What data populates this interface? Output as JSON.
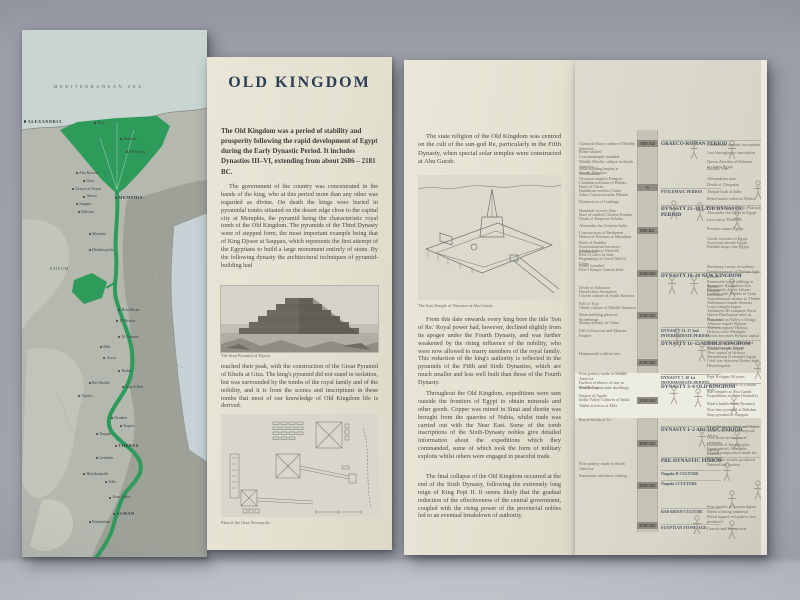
{
  "colors": {
    "background": "#9fa1ab",
    "paper_cream": "#e4e1d1",
    "map_land": "#b6bab1",
    "map_sea": "#c9d5d1",
    "nile_green": "#2f9b5b",
    "timeline_paper": "#d8d6c9",
    "timeline_highlight": "#edece1",
    "title_ink": "#2c3e54",
    "body_ink": "#4b493f"
  },
  "panel_old_kingdom": {
    "title": "OLD KINGDOM",
    "intro": "The Old Kingdom was a period of stability and prosperity following the rapid development of Egypt during the Early Dynastic Period. It includes Dynasties III–VI, extending from about 2686 – 2181 BC.",
    "para1": "The government of the country was concentrated in the hands of the king, who at this period more than any other was regarded as divine. On death the kings were buried in pyramidal tombs situated on the desert edge close to the capital city at Memphis, the pyramid being the characteristic royal tomb of the Old Kingdom. The pyramids of the Third Dynasty were of stepped form, the most important example being that of King Djoser at Saqqara, which represents the first attempt of the Egyptians to build a large monument entirely of stone. By the following dynasty the architectural techniques of pyramid-building had",
    "photo_caption": "The Step Pyramid of Djoser",
    "para2": "reached their peak, with the construction of the Great Pyramid of Khufu at Giza. The king's pyramid did not stand in isolation, but was surrounded by the tombs of the royal family and of the nobility, and it is from the scenes and inscriptions in these tombs that most of our knowledge of Old Kingdom life is derived.",
    "plan_caption": "Plan of the Giza Necropolis"
  },
  "panel_religion": {
    "para1": "The state religion of the Old Kingdom was centred on the cult of the sun-god Re, particularly in the Fifth Dynasty, when special solar temples were constructed at Abu Gurab.",
    "drawing_caption": "The Sun Temple of Niuserre at Abu Gurab.",
    "para2": "From this date onwards every king bore the title 'Son of Re.' Royal power had, however, declined slightly from its apogee under the Fourth Dynasty, and was further weakened by the rising influence of the nobility, who were now allowed to marry members of the royal family. This reduction of the king's authority is reflected in the pyramids of the Fifth and Sixth Dynasties, which are much smaller and less well built than those of the Fourth Dynasty.",
    "para3": "Throughout the Old Kingdom, expeditions were sent outside the frontiers of Egypt to obtain minerals and other goods. Copper was mined in Sinai and diorite was brought from the quarries of Nubia, whilst trade was carried out with the Near East. Some of the tomb inscriptions of the Sixth-Dynasty nobles give detailed information about the expeditions which they commanded, some of which took the form of military exploits whilst others were engaged in peaceful trade.",
    "para4": "The final collapse of the Old Kingdom occurred at the end of the Sixth Dynasty, following the extremely long reign of King Pepi II. It seems likely that the gradual reduction of the effectiveness of the central government, coupled with the rising power of the provincial nobles led to an eventual breakdown of authority."
  },
  "map": {
    "labels": [
      {
        "x": 17,
        "y": 10.5,
        "text": "MEDITERRANEAN SEA",
        "cls": "sea"
      },
      {
        "x": 1,
        "y": 17,
        "text": "ALEXANDRIA",
        "cls": "big"
      },
      {
        "x": 39,
        "y": 17.5,
        "text": "Buto",
        "cls": "city"
      },
      {
        "x": 53,
        "y": 20.5,
        "text": "Bubastis",
        "cls": "city"
      },
      {
        "x": 56,
        "y": 23,
        "text": "Heliopolis",
        "cls": "city"
      },
      {
        "x": 29,
        "y": 27,
        "text": "Abu Rawash",
        "cls": "city"
      },
      {
        "x": 33,
        "y": 28.5,
        "text": "Giza",
        "cls": "city"
      },
      {
        "x": 27,
        "y": 30,
        "text": "Zawyet el-Aryan",
        "cls": "city"
      },
      {
        "x": 33,
        "y": 31.4,
        "text": "Abusir",
        "cls": "city"
      },
      {
        "x": 29,
        "y": 32.8,
        "text": "Saqqara",
        "cls": "city"
      },
      {
        "x": 50,
        "y": 31.5,
        "text": "MEMPHIS",
        "cls": "big"
      },
      {
        "x": 30,
        "y": 34.4,
        "text": "Dahshur",
        "cls": "city"
      },
      {
        "x": 36,
        "y": 38.5,
        "text": "Meydum",
        "cls": "city"
      },
      {
        "x": 15,
        "y": 45,
        "text": "FAIYUM",
        "cls": "region"
      },
      {
        "x": 36,
        "y": 41.5,
        "text": "Herakleopolis",
        "cls": "city"
      },
      {
        "x": 52,
        "y": 53,
        "text": "Beni Hasan",
        "cls": "city"
      },
      {
        "x": 51,
        "y": 55,
        "text": "El-Bersha",
        "cls": "city"
      },
      {
        "x": 52,
        "y": 58,
        "text": "El-Amarna",
        "cls": "city"
      },
      {
        "x": 42,
        "y": 60,
        "text": "Meir",
        "cls": "city"
      },
      {
        "x": 44,
        "y": 62,
        "text": "Asyut",
        "cls": "city"
      },
      {
        "x": 52,
        "y": 64.5,
        "text": "Badari",
        "cls": "city"
      },
      {
        "x": 36,
        "y": 66.8,
        "text": "Bet Khallaf",
        "cls": "city"
      },
      {
        "x": 54,
        "y": 67.5,
        "text": "Nag el-Deir",
        "cls": "city"
      },
      {
        "x": 30,
        "y": 69.2,
        "text": "Abydos",
        "cls": "city"
      },
      {
        "x": 48,
        "y": 73.5,
        "text": "Dendera",
        "cls": "city"
      },
      {
        "x": 53,
        "y": 75,
        "text": "Koptos",
        "cls": "city"
      },
      {
        "x": 40,
        "y": 76.5,
        "text": "Naqada",
        "cls": "city"
      },
      {
        "x": 50,
        "y": 78.5,
        "text": "THEBES",
        "cls": "big"
      },
      {
        "x": 40,
        "y": 81,
        "text": "Gebelein",
        "cls": "city"
      },
      {
        "x": 33,
        "y": 84,
        "text": "Hierakonpolis",
        "cls": "city"
      },
      {
        "x": 45,
        "y": 85.5,
        "text": "Edfu",
        "cls": "city"
      },
      {
        "x": 47,
        "y": 88.5,
        "text": "Kom Ombo",
        "cls": "city"
      },
      {
        "x": 49,
        "y": 91.5,
        "text": "ASWAN",
        "cls": "big"
      },
      {
        "x": 36,
        "y": 93.2,
        "text": "Elephantine",
        "cls": "city"
      }
    ]
  },
  "timeline": {
    "dates": [
      {
        "top": 80,
        "label": "500 AD"
      },
      {
        "top": 124,
        "label": "0"
      },
      {
        "top": 167,
        "label": "500 BC"
      },
      {
        "top": 210,
        "label": "1000 BC"
      },
      {
        "top": 252,
        "label": "1500 BC"
      },
      {
        "top": 299,
        "label": "2000 BC"
      },
      {
        "top": 337,
        "label": "2500 BC"
      },
      {
        "top": 380,
        "label": "3000 BC"
      },
      {
        "top": 422,
        "label": "3500 BC"
      },
      {
        "top": 462,
        "label": "4000 BC"
      }
    ],
    "world_events": [
      {
        "top": 82,
        "text": "Classical Maya culture of Middle America"
      },
      {
        "top": 90,
        "text": "Rome sacked"
      },
      {
        "top": 95,
        "text": "Constantinople founded"
      },
      {
        "top": 100,
        "text": "Middle Mochic culture in South America"
      },
      {
        "top": 107,
        "text": "Stela building begins at Teotihuacan"
      },
      {
        "top": 111,
        "text": "Jewish Diaspora"
      },
      {
        "top": 117,
        "text": "Vesuvius engulfs Pompeii"
      },
      {
        "top": 121,
        "text": "Claudian invasion of Britain"
      },
      {
        "top": 125,
        "text": "Birth of Christ"
      },
      {
        "top": 129,
        "text": "Buddhism reaches China"
      },
      {
        "top": 133,
        "text": "Julius Caesar invades Britain"
      },
      {
        "top": 140,
        "text": "Destruction of Carthage"
      },
      {
        "top": 149,
        "text": "Hannibal crosses Alps"
      },
      {
        "top": 153,
        "text": "Start of unified Chinese Empire"
      },
      {
        "top": 157,
        "text": "Death of Emperor Ashoka"
      },
      {
        "top": 164,
        "text": "Alexander the Great in India"
      },
      {
        "top": 171,
        "text": "Construction of Parthenon"
      },
      {
        "top": 175,
        "text": "Defeat of Persians at Marathon"
      },
      {
        "top": 181,
        "text": "Birth of Buddha"
      },
      {
        "top": 185,
        "text": "Zoroastrianism becomes formalised"
      },
      {
        "top": 189,
        "text": "Medes destroy Nineveh"
      },
      {
        "top": 193,
        "text": "Rise of cities in Italy"
      },
      {
        "top": 197,
        "text": "Beginnings of Great Wall of China"
      },
      {
        "top": 204,
        "text": "Rome founded"
      },
      {
        "top": 208,
        "text": "First Olympic Games held"
      },
      {
        "top": 226,
        "text": "Death of Solomon"
      },
      {
        "top": 230,
        "text": "David takes Jerusalem"
      },
      {
        "top": 234,
        "text": "Chavin culture of South America"
      },
      {
        "top": 242,
        "text": "Fall of Troy"
      },
      {
        "top": 246,
        "text": "Olmec culture of Middle America"
      },
      {
        "top": 253,
        "text": "Main building phase at Stonehenge"
      },
      {
        "top": 261,
        "text": "Shang dynasty in China"
      },
      {
        "top": 269,
        "text": "Fall of Knossos and Minoan Empire"
      },
      {
        "top": 292,
        "text": "Hammurabi codifies law"
      },
      {
        "top": 312,
        "text": "First pottery made in Middle America"
      },
      {
        "top": 321,
        "text": "Earliest evidence of war in Middle East"
      },
      {
        "top": 326,
        "text": "First European lake dwellings"
      },
      {
        "top": 334,
        "text": "Sargon of Agade"
      },
      {
        "top": 338,
        "text": "Indus Valley Cultures of India"
      },
      {
        "top": 344,
        "text": "Tablet archives at Ebla"
      },
      {
        "top": 358,
        "text": "Royal burials at Ur"
      },
      {
        "top": 402,
        "text": "First pottery made in South America"
      },
      {
        "top": 414,
        "text": "Sumerians introduce writing"
      }
    ],
    "periods": [
      {
        "top": 80,
        "label": "GRAECO-ROMAN PERIOD"
      },
      {
        "top": 128,
        "label": "PTOLEMAIC PERIOD",
        "cls": "sm"
      },
      {
        "top": 145,
        "label": "DYNASTY 21–30 LATE DYNASTIC PERIOD"
      },
      {
        "top": 212,
        "label": "DYNASTY 18–20 NEW KINGDOM"
      },
      {
        "top": 267,
        "label": "DYNASTY 13–17 2nd INTERMEDIATE PERIOD",
        "cls": "sm"
      },
      {
        "top": 280,
        "label": "DYNASTY 11–12 MIDDLE KINGDOM"
      },
      {
        "top": 314,
        "label": "DYNASTY 7–10 1st INTERMEDIATE PERIOD",
        "cls": "sm"
      },
      {
        "top": 323,
        "label": "DYNASTY 3–6 OLD KINGDOM"
      },
      {
        "top": 366,
        "label": "DYNASTY 1–2 ARCHAIC PERIOD"
      },
      {
        "top": 397,
        "label": "PRE-DYNASTIC PERIOD"
      },
      {
        "top": 410,
        "label": "Naqada II CULTURE",
        "cls": "sm"
      },
      {
        "top": 420,
        "label": "Naqada I CULTURE",
        "cls": "sm"
      },
      {
        "top": 448,
        "label": "BADARIAN CULTURE",
        "cls": "sm"
      },
      {
        "top": 464,
        "label": "EGYPTIAN STONE-AGE",
        "cls": "sm"
      }
    ],
    "egypt_events": [
      {
        "top": 83,
        "text": "Last known demotic inscription"
      },
      {
        "top": 91,
        "text": "Last hieroglyphic inscription"
      },
      {
        "top": 100,
        "text": "Queen Zenobia of Palmyra occupies Egypt"
      },
      {
        "top": 107,
        "text": "Bucolic War"
      },
      {
        "top": 117,
        "text": "Alexandrian riots"
      },
      {
        "top": 123,
        "text": "Death of Cleopatra"
      },
      {
        "top": 130,
        "text": "Temple built at Edfu"
      },
      {
        "top": 137,
        "text": "Rebel native rulers at Thebes"
      },
      {
        "top": 146,
        "text": "Ptolemy Lagus rules as Pharaoh"
      },
      {
        "top": 151,
        "text": "Alexander the Great in Egypt"
      },
      {
        "top": 158,
        "text": "Last native Pharaohs"
      },
      {
        "top": 167,
        "text": "Persians annex Egypt"
      },
      {
        "top": 177,
        "text": "Greek colonies in Egypt"
      },
      {
        "top": 181,
        "text": "Assyrians invade Egypt"
      },
      {
        "top": 185,
        "text": "Kushite kings rule Egypt"
      },
      {
        "top": 205,
        "text": "Sheshonq I sacks Jerusalem"
      },
      {
        "top": 210,
        "text": "Greatest power of Theban high priests"
      },
      {
        "top": 220,
        "text": "Ramesside tomb robbing at Thebes"
      },
      {
        "top": 224,
        "text": "Ramesses III repulses Sea Peoples"
      },
      {
        "top": 228,
        "text": "Merneptah checks Libyan invasions"
      },
      {
        "top": 232,
        "text": "Clashes with Hittites in Syria"
      },
      {
        "top": 237,
        "text": "Tutankhamun returns to Thebes"
      },
      {
        "top": 241,
        "text": "Akhenaten founds Amarna"
      },
      {
        "top": 245,
        "text": "Luxor temple begun"
      },
      {
        "top": 249,
        "text": "Tuthmosis III conquers Syria"
      },
      {
        "top": 253,
        "text": "Queen Hatshepsut rules as Pharaoh"
      },
      {
        "top": 258,
        "text": "First tomb in Valley of Kings"
      },
      {
        "top": 262,
        "text": "Ahmose expels Hyksos"
      },
      {
        "top": 266,
        "text": "Thebans oppose Hyksos"
      },
      {
        "top": 270,
        "text": "Hyksos seize Memphis"
      },
      {
        "top": 274,
        "text": "Avaris becomes Hyksos capital"
      },
      {
        "top": 281,
        "text": "Trade with Asia, Africa and Mediterranean Islands"
      },
      {
        "top": 287,
        "text": "Karnak temple begun"
      },
      {
        "top": 291,
        "text": "New capital at Itj-tawy"
      },
      {
        "top": 295,
        "text": "Mentuhotep II reunites Egypt"
      },
      {
        "top": 299,
        "text": "Civil war between Thebes and Heracleopolis"
      },
      {
        "top": 315,
        "text": "Pepi II reigns 94 years"
      },
      {
        "top": 323,
        "text": "Unas pyramid first to contain texts"
      },
      {
        "top": 330,
        "text": "Sun temples at Abu Gurab"
      },
      {
        "top": 334,
        "text": "Expeditions to Punt (Somalia)"
      },
      {
        "top": 342,
        "text": "Khufu builds Great Pyramid"
      },
      {
        "top": 348,
        "text": "First true pyramid at Dahshur"
      },
      {
        "top": 353,
        "text": "Step pyramid at Saqqara"
      },
      {
        "top": 365,
        "text": "Expeditions to Sinai and Nubia"
      },
      {
        "top": 369,
        "text": "Trade with Asia and tropical Africa"
      },
      {
        "top": 376,
        "text": "First stone architectural elements"
      },
      {
        "top": 383,
        "text": "Invention of hieroglyphic writing"
      },
      {
        "top": 387,
        "text": "Egypt united; Memphis founded"
      },
      {
        "top": 391,
        "text": "Glazed composition made for first time"
      },
      {
        "top": 398,
        "text": "Hard stone vessels produced"
      },
      {
        "top": 403,
        "text": "Painted buff pottery"
      },
      {
        "top": 445,
        "text": "First models of human figure"
      },
      {
        "top": 450,
        "text": "Metal working unknown"
      },
      {
        "top": 455,
        "text": "Black topped red pottery first produced"
      },
      {
        "top": 467,
        "text": "Cereals and flax grown"
      }
    ],
    "sketches": [
      {
        "top": 80,
        "left": 112
      },
      {
        "top": 80,
        "left": 150
      },
      {
        "top": 120,
        "left": 176
      },
      {
        "top": 140,
        "left": 92
      },
      {
        "top": 142,
        "left": 118
      },
      {
        "top": 150,
        "left": 155
      },
      {
        "top": 215,
        "left": 90
      },
      {
        "top": 215,
        "left": 112
      },
      {
        "top": 218,
        "left": 150
      },
      {
        "top": 268,
        "left": 95
      },
      {
        "top": 282,
        "left": 120
      },
      {
        "top": 300,
        "left": 176
      },
      {
        "top": 325,
        "left": 92
      },
      {
        "top": 328,
        "left": 116
      },
      {
        "top": 335,
        "left": 152
      },
      {
        "top": 368,
        "left": 120
      },
      {
        "top": 370,
        "left": 155
      },
      {
        "top": 402,
        "left": 145
      },
      {
        "top": 420,
        "left": 176
      },
      {
        "top": 430,
        "left": 150
      },
      {
        "top": 455,
        "left": 115
      },
      {
        "top": 460,
        "left": 150
      }
    ]
  }
}
